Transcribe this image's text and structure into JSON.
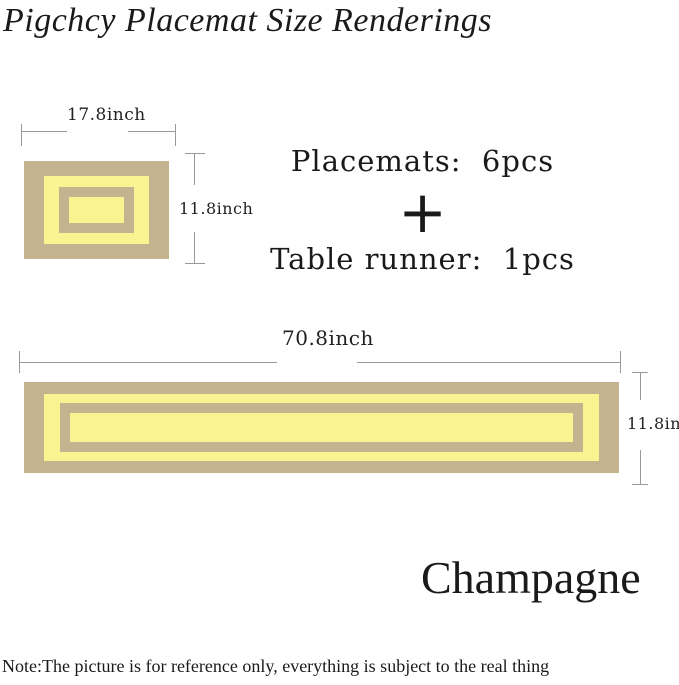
{
  "title": "Pigchcy Placemat Size Renderings",
  "colors": {
    "mat_tan": "#c5b28e",
    "mat_yellow": "#fbf292",
    "dim_line": "#9a9a9a",
    "text": "#1a1a1a"
  },
  "placemat": {
    "width_label": "17.8inch",
    "height_label": "11.8inch"
  },
  "set_info": {
    "placemats": "Placemats:  6pcs",
    "plus_sign": "+",
    "table_runner": "Table runner:  1pcs"
  },
  "runner": {
    "width_label": "70.8inch",
    "height_label": "11.8inch"
  },
  "color_name": "Champagne",
  "note": "Note:The picture is for reference only, everything is subject to the real thing"
}
